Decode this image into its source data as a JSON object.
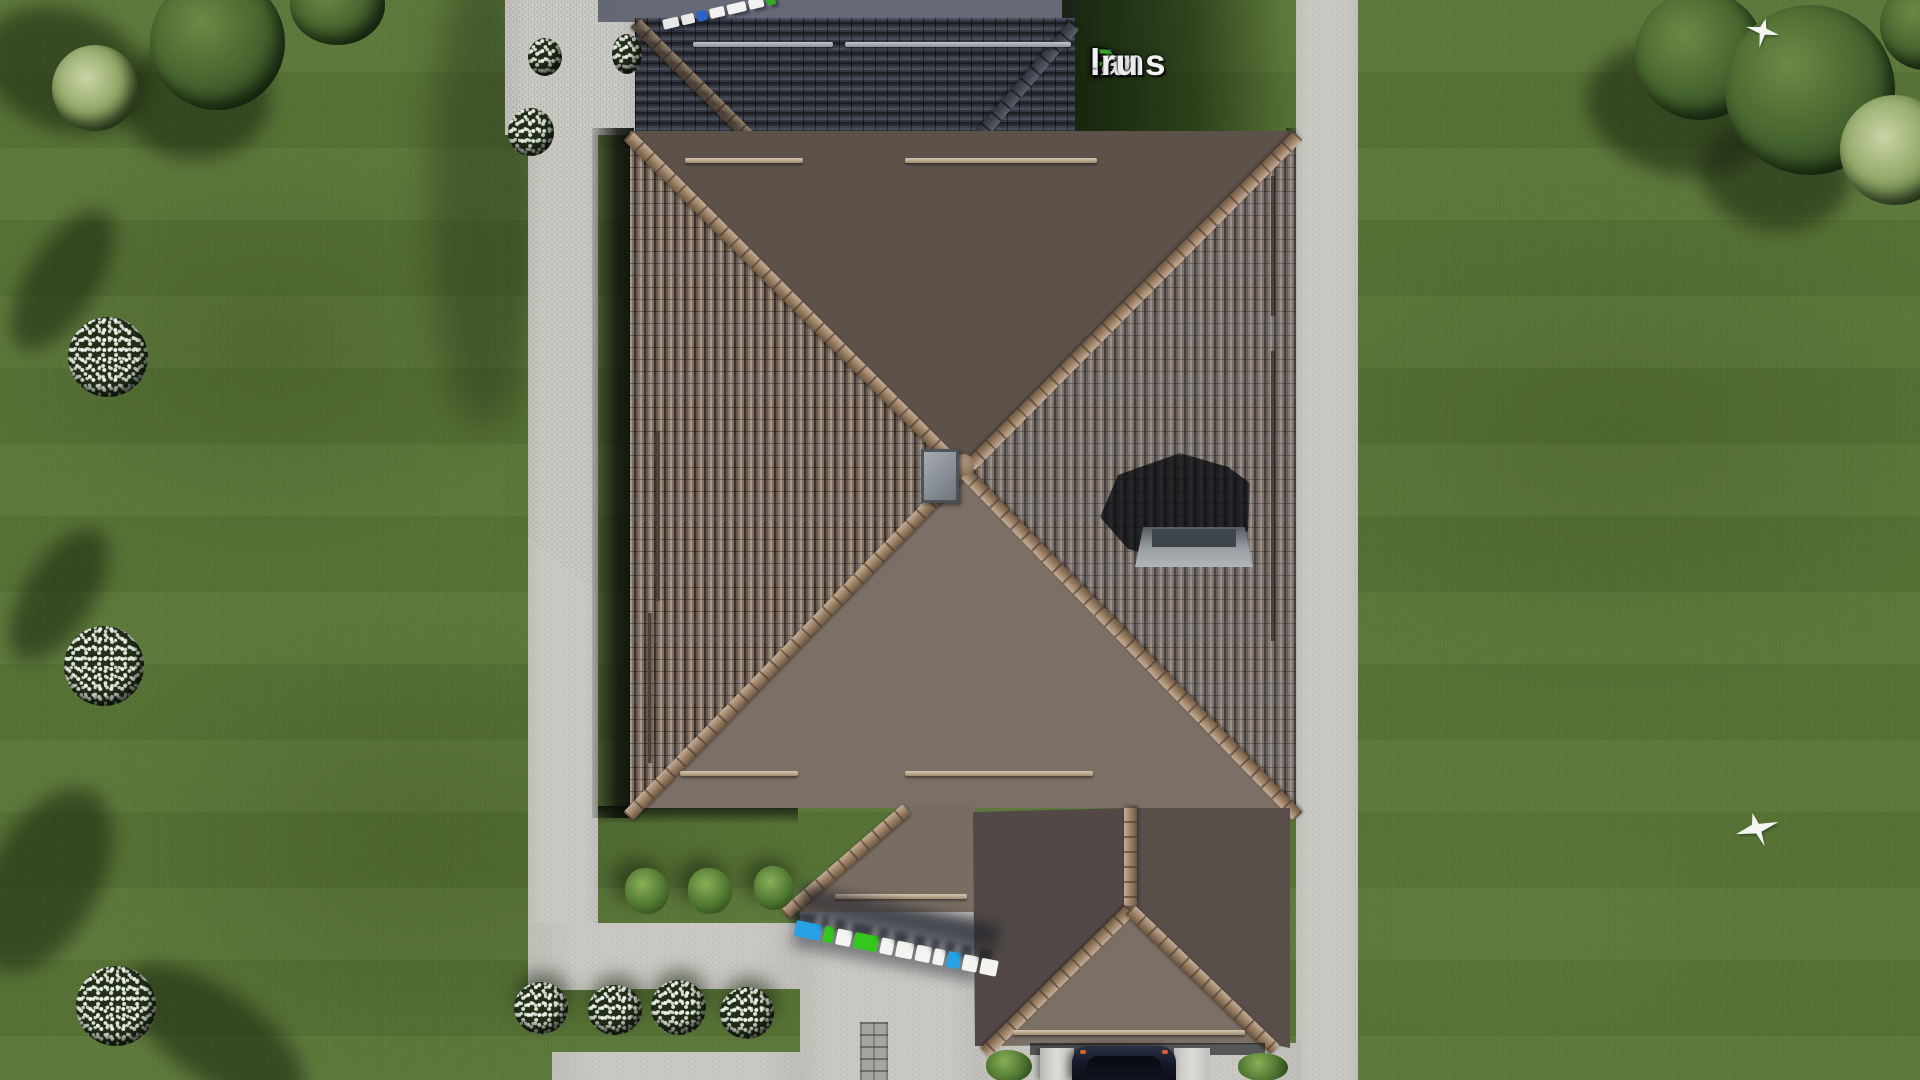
{
  "brand": {
    "watermark_text": "FixPlans.ru",
    "logo_segments": [
      {
        "text": "F",
        "color": "#2e7ce0"
      },
      {
        "text": "ix",
        "color": "#f2f3f1"
      },
      {
        "text": "P",
        "color": "#3faf2b"
      },
      {
        "text": "lans",
        "color": "#f2f3f1"
      },
      {
        "text": ".ru",
        "color": "#ececea"
      }
    ]
  },
  "ground_watermark": {
    "text": "FixPlans.ru",
    "blocks": [
      {
        "color": "#28a2e6",
        "width": 26
      },
      {
        "color": "#34c81e",
        "width": 10
      },
      {
        "color": "#f4f4f0",
        "width": 15
      },
      {
        "color": "#34c81e",
        "width": 24
      },
      {
        "color": "#f4f4f0",
        "width": 13
      },
      {
        "color": "#f4f4f0",
        "width": 17
      },
      {
        "color": "#f4f4f0",
        "width": 15
      },
      {
        "color": "#f4f4f0",
        "width": 11
      },
      {
        "color": "#28a2e6",
        "width": 13
      },
      {
        "color": "#f4f4f0",
        "width": 15
      },
      {
        "color": "#f4f4f0",
        "width": 17
      }
    ]
  },
  "top_watermark": {
    "text": "FixPlans.ru",
    "blocks": [
      {
        "color": "#e8e9e6",
        "width": 16
      },
      {
        "color": "#e8e9e6",
        "width": 13
      },
      {
        "color": "#2763c9",
        "width": 10
      },
      {
        "color": "#f2f3f0",
        "width": 15
      },
      {
        "color": "#f2f3f0",
        "width": 19
      },
      {
        "color": "#f2f3f0",
        "width": 15
      },
      {
        "color": "#2fae22",
        "width": 9
      }
    ]
  },
  "palette": {
    "lawn": "#5b7838",
    "lawn_shadow": "#2c4220",
    "pavement": "#cbcac5",
    "pavement_shadow": "#71768a",
    "roof_tile_light": "#b2a08f",
    "roof_tile_dark": "#39322d",
    "roof_shadowed": "#2f313a",
    "ridge_cap": "#a98f73",
    "chimney": "#8e959c",
    "car_body": "#1b2230"
  },
  "scene_counts": {
    "birds": 2,
    "white_flower_bushes_bottom": 4,
    "trimmed_green_bushes": 3
  }
}
